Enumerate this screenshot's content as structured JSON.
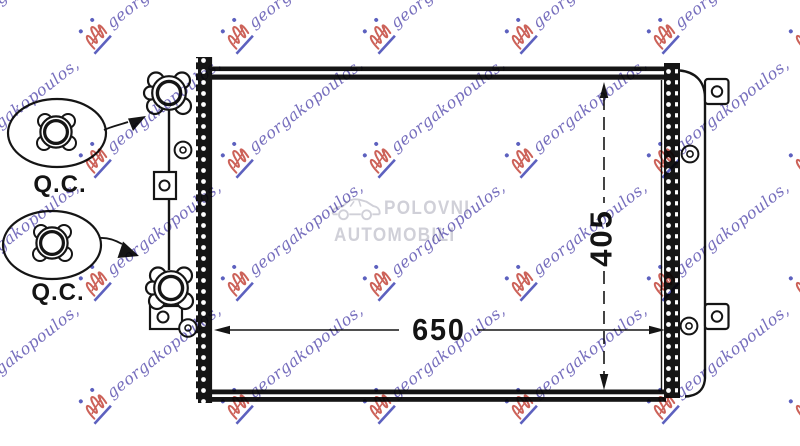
{
  "diagram": {
    "width_label": "650",
    "height_label": "405",
    "qc_top": "Q.C.",
    "qc_bottom": "Q.C.",
    "ink_color": "#141414"
  },
  "watermark": {
    "text": "georgakopoulos,",
    "text_color": "#5f55b2",
    "logo_red": "#c4473c",
    "logo_blue": "#4146b4"
  },
  "center_watermark": {
    "line1": "POLOVNI",
    "line2": "AUTOMOBILI",
    "icon": "car-icon",
    "color": "#d0d0d8"
  }
}
